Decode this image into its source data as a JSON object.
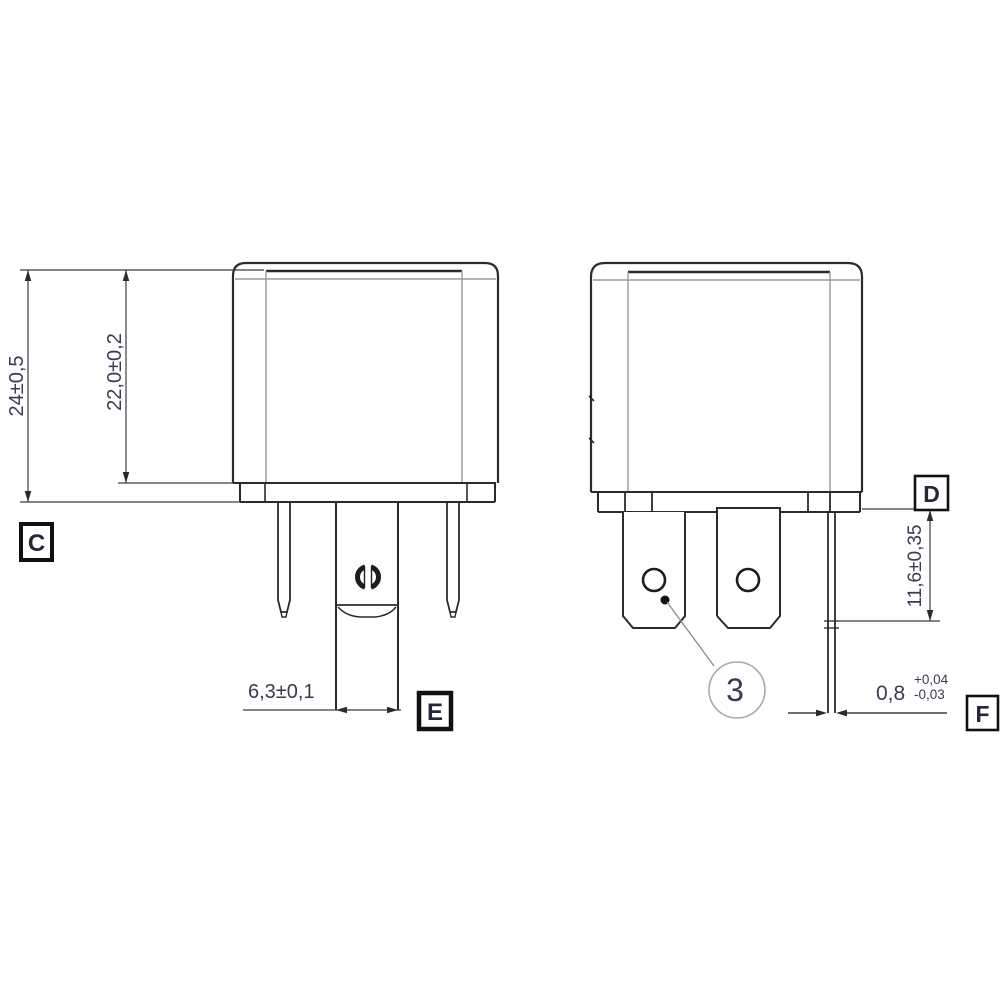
{
  "drawing": {
    "description": "Technical drawing of an automotive relay, two side views with datum labels and toleranced dimensions",
    "colors": {
      "line": "#2b2b2b",
      "ghost_line": "#9b9b9b",
      "dim_line": "#3c3c3c",
      "text": "#3a3a52",
      "datum_text": "#26263a",
      "balloon_stroke": "#aaaaaa",
      "background": "#ffffff"
    },
    "left_view": {
      "dim_overall_height": "24±0,5",
      "dim_body_height": "22,0±0,2",
      "dim_blade_width": "6,3±0,1",
      "datum_c": "C",
      "datum_e": "E"
    },
    "right_view": {
      "dim_terminal_length": "11,6±0,35",
      "dim_blade_thickness": "0,8",
      "dim_blade_thickness_tol_upper": "+0,04",
      "dim_blade_thickness_tol_lower": "-0,03",
      "datum_d": "D",
      "datum_f": "F",
      "balloon_label": "3"
    }
  }
}
